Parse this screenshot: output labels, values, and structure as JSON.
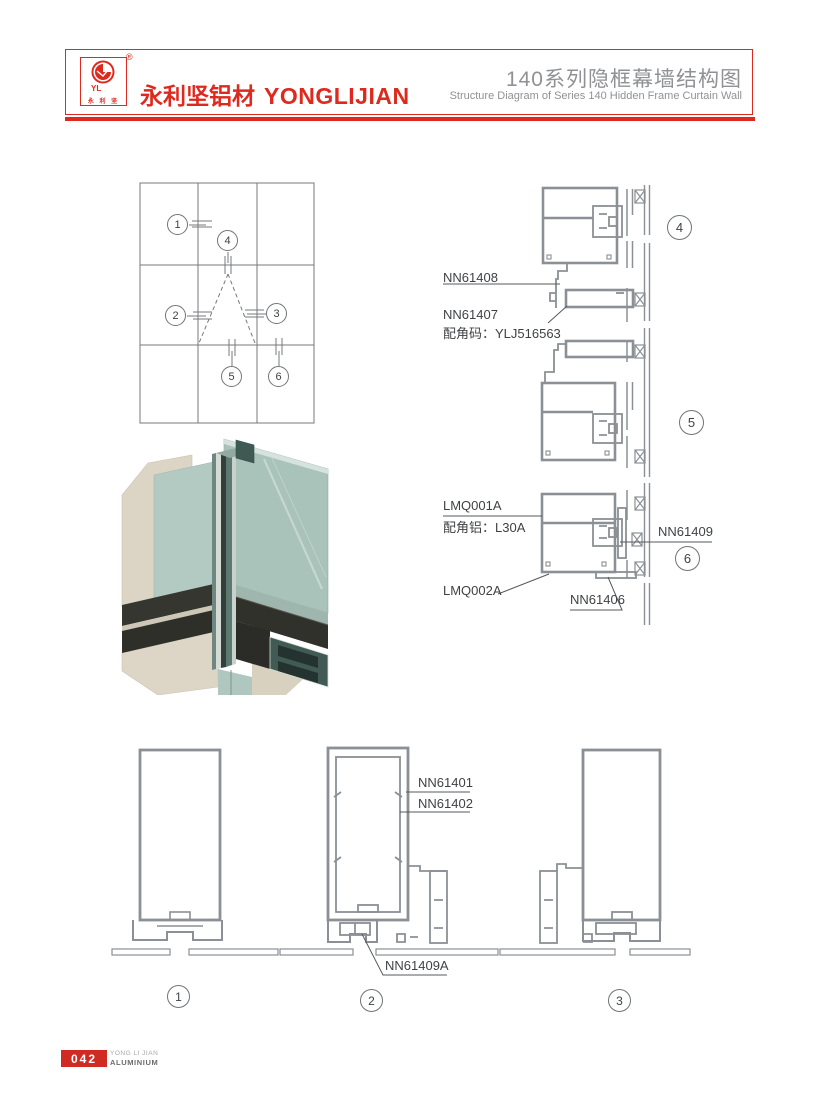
{
  "header": {
    "registered_mark": "®",
    "logo_monogram": "YL",
    "logo_chars": "永 利 坚",
    "brand_cn": "永利坚铝材",
    "brand_en": "YONGLIJIAN",
    "title_cn": "140系列隐框幕墙结构图",
    "title_en": "Structure Diagram of Series 140 Hidden Frame Curtain Wall"
  },
  "elevation_markers": [
    "1",
    "2",
    "3",
    "4",
    "5",
    "6"
  ],
  "vertical_section_markers": [
    "4",
    "5",
    "6"
  ],
  "horizontal_section_markers": [
    "1",
    "2",
    "3"
  ],
  "section_labels": {
    "nn61408": "NN61408",
    "nn61407": "NN61407",
    "nn61407_code": "配角码：YLJ516563",
    "lmq001a": "LMQ001A",
    "lmq001a_code": "配角铝：L30A",
    "nn61409": "NN61409",
    "lmq002a": "LMQ002A",
    "nn61406": "NN61406",
    "nn61401": "NN61401",
    "nn61402": "NN61402",
    "nn61409a": "NN61409A"
  },
  "footer": {
    "page_number": "042",
    "brand_line1": "YONG LI JIAN",
    "brand_line2": "ALUMINIUM"
  },
  "colors": {
    "brand_red": "#DE2A1E",
    "drawing_gray": "#8A9095",
    "label_gray": "#3F4245",
    "title_gray": "#8F9194"
  }
}
